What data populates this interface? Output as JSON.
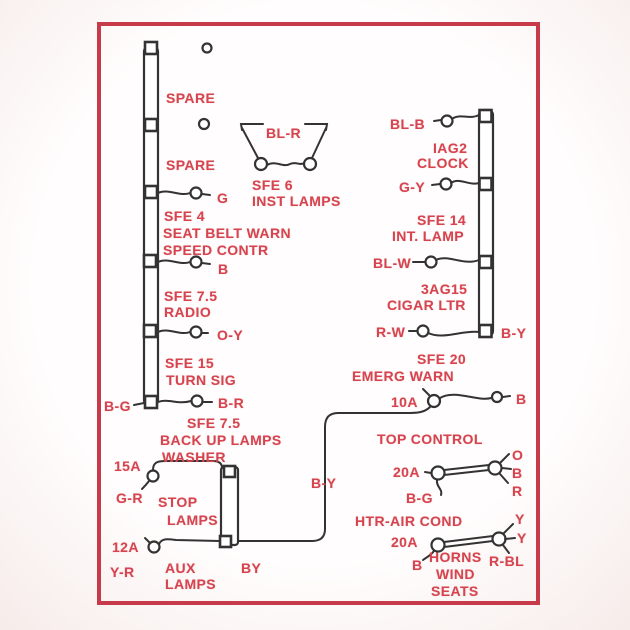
{
  "diagram": {
    "description": "Fuse panel wiring diagram, red print on white card",
    "colors": {
      "text_red": "#d6454f",
      "border_red": "#c63a4a",
      "wire_black": "#333333",
      "background": "#faf5f3"
    },
    "labels": [
      {
        "name": "spare-1-label",
        "text": "SPARE",
        "x": 166,
        "y": 91
      },
      {
        "name": "spare-2-label",
        "text": "SPARE",
        "x": 166,
        "y": 158
      },
      {
        "name": "wire-color-g",
        "text": "G",
        "x": 217,
        "y": 191
      },
      {
        "name": "fuse-sfe4-label",
        "text": "SFE 4",
        "x": 164,
        "y": 209
      },
      {
        "name": "circuit-seat-belt-warn",
        "text": "SEAT BELT WARN",
        "x": 163,
        "y": 226
      },
      {
        "name": "circuit-speed-contr",
        "text": "SPEED CONTR",
        "x": 163,
        "y": 243
      },
      {
        "name": "wire-color-b-1",
        "text": "B",
        "x": 218,
        "y": 262
      },
      {
        "name": "fuse-sfe75-radio-label",
        "text": "SFE 7.5",
        "x": 164,
        "y": 289
      },
      {
        "name": "circuit-radio",
        "text": "RADIO",
        "x": 164,
        "y": 305
      },
      {
        "name": "wire-color-oy",
        "text": "O-Y",
        "x": 217,
        "y": 328
      },
      {
        "name": "fuse-sfe15-label",
        "text": "SFE 15",
        "x": 165,
        "y": 356
      },
      {
        "name": "circuit-turn-sig",
        "text": "TURN SIG",
        "x": 166,
        "y": 373
      },
      {
        "name": "wire-color-bg-1",
        "text": "B-G",
        "x": 104,
        "y": 399
      },
      {
        "name": "wire-color-br",
        "text": "B-R",
        "x": 218,
        "y": 396
      },
      {
        "name": "fuse-sfe75-backup-label",
        "text": "SFE 7.5",
        "x": 187,
        "y": 416
      },
      {
        "name": "circuit-back-up-lamps",
        "text": "BACK UP LAMPS",
        "x": 160,
        "y": 433
      },
      {
        "name": "circuit-washer",
        "text": "WASHER",
        "x": 162,
        "y": 450
      },
      {
        "name": "amp-15a",
        "text": "15A",
        "x": 114,
        "y": 459
      },
      {
        "name": "wire-color-gr",
        "text": "G-R",
        "x": 116,
        "y": 491
      },
      {
        "name": "circuit-stop",
        "text": "STOP",
        "x": 158,
        "y": 495
      },
      {
        "name": "circuit-stop-lamps",
        "text": "LAMPS",
        "x": 167,
        "y": 513
      },
      {
        "name": "amp-12a",
        "text": "12A",
        "x": 112,
        "y": 540
      },
      {
        "name": "wire-color-yr",
        "text": "Y-R",
        "x": 110,
        "y": 565
      },
      {
        "name": "circuit-aux",
        "text": "AUX",
        "x": 165,
        "y": 561
      },
      {
        "name": "circuit-aux-lamps",
        "text": "LAMPS",
        "x": 165,
        "y": 577
      },
      {
        "name": "wire-color-by-small",
        "text": "BY",
        "x": 241,
        "y": 561
      },
      {
        "name": "wire-color-by-mid",
        "text": "B-Y",
        "x": 311,
        "y": 476
      },
      {
        "name": "wire-color-blr",
        "text": "BL-R",
        "x": 266,
        "y": 126
      },
      {
        "name": "fuse-sfe6-label",
        "text": "SFE 6",
        "x": 252,
        "y": 178
      },
      {
        "name": "circuit-inst-lamps",
        "text": "INST LAMPS",
        "x": 252,
        "y": 194
      },
      {
        "name": "wire-color-blb",
        "text": "BL-B",
        "x": 390,
        "y": 117
      },
      {
        "name": "fuse-iag2-label",
        "text": "IAG2",
        "x": 433,
        "y": 141
      },
      {
        "name": "circuit-clock",
        "text": "CLOCK",
        "x": 417,
        "y": 156
      },
      {
        "name": "wire-color-gy",
        "text": "G-Y",
        "x": 399,
        "y": 180
      },
      {
        "name": "fuse-sfe14-label",
        "text": "SFE 14",
        "x": 417,
        "y": 213
      },
      {
        "name": "circuit-int-lamp",
        "text": "INT. LAMP",
        "x": 392,
        "y": 229
      },
      {
        "name": "wire-color-blw",
        "text": "BL-W",
        "x": 373,
        "y": 256
      },
      {
        "name": "fuse-3ag15-label",
        "text": "3AG15",
        "x": 421,
        "y": 282
      },
      {
        "name": "circuit-cigar-ltr",
        "text": "CIGAR LTR",
        "x": 387,
        "y": 298
      },
      {
        "name": "wire-color-rw",
        "text": "R-W",
        "x": 376,
        "y": 325
      },
      {
        "name": "wire-color-by-right",
        "text": "B-Y",
        "x": 501,
        "y": 326
      },
      {
        "name": "fuse-sfe20-label",
        "text": "SFE 20",
        "x": 417,
        "y": 352
      },
      {
        "name": "circuit-emerg-warn",
        "text": "EMERG WARN",
        "x": 352,
        "y": 369
      },
      {
        "name": "amp-10a",
        "text": "10A",
        "x": 391,
        "y": 395
      },
      {
        "name": "wire-color-b-2",
        "text": "B",
        "x": 516,
        "y": 392
      },
      {
        "name": "circuit-top-control",
        "text": "TOP CONTROL",
        "x": 377,
        "y": 432
      },
      {
        "name": "amp-20a-1",
        "text": "20A",
        "x": 393,
        "y": 465
      },
      {
        "name": "wire-color-o",
        "text": "O",
        "x": 512,
        "y": 448
      },
      {
        "name": "wire-color-b-3",
        "text": "B",
        "x": 512,
        "y": 466
      },
      {
        "name": "wire-color-r",
        "text": "R",
        "x": 512,
        "y": 484
      },
      {
        "name": "wire-color-bg-2",
        "text": "B-G",
        "x": 406,
        "y": 491
      },
      {
        "name": "circuit-htr-air-cond",
        "text": "HTR-AIR COND",
        "x": 355,
        "y": 514
      },
      {
        "name": "amp-20a-2",
        "text": "20A",
        "x": 391,
        "y": 535
      },
      {
        "name": "wire-color-y-1",
        "text": "Y",
        "x": 515,
        "y": 512
      },
      {
        "name": "wire-color-y-2",
        "text": "Y",
        "x": 517,
        "y": 531
      },
      {
        "name": "wire-color-rbl",
        "text": "R-BL",
        "x": 489,
        "y": 554
      },
      {
        "name": "wire-color-b-4",
        "text": "B",
        "x": 412,
        "y": 558
      },
      {
        "name": "circuit-horns",
        "text": "HORNS",
        "x": 429,
        "y": 550
      },
      {
        "name": "circuit-wind",
        "text": "WIND",
        "x": 436,
        "y": 567
      },
      {
        "name": "circuit-seats",
        "text": "SEATS",
        "x": 431,
        "y": 584
      }
    ]
  }
}
